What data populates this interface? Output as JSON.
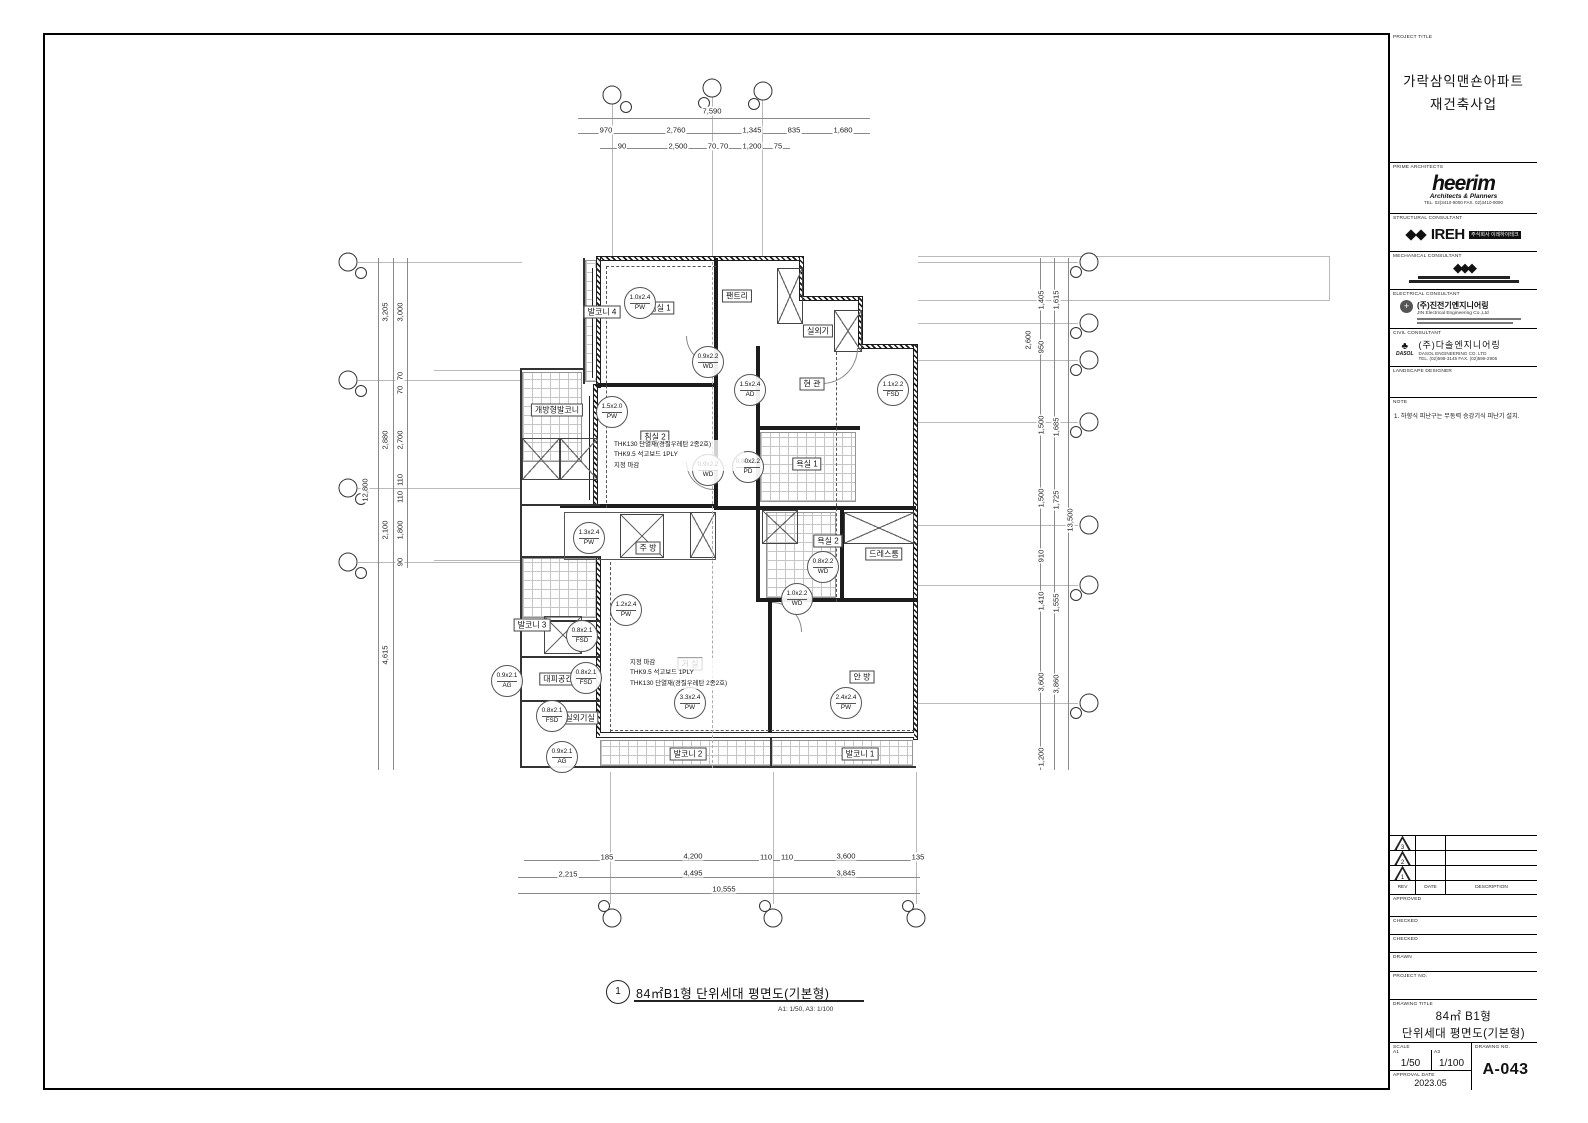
{
  "plan": {
    "rooms": [
      "침실 1",
      "침실 2",
      "팬트리",
      "실외기",
      "현 관",
      "욕실 1",
      "욕실 2",
      "드레스룸",
      "주 방",
      "거 실",
      "안 방",
      "발코니 1",
      "발코니 2",
      "발코니 3",
      "발코니 4",
      "개방형발코니",
      "대피공간",
      "실외기실"
    ],
    "tags": [
      {
        "s": "1.0x2.4",
        "c": "PW"
      },
      {
        "s": "0.9x2.2",
        "c": "WD"
      },
      {
        "s": "1.5x2.4",
        "c": "AD"
      },
      {
        "s": "1.1x2.2",
        "c": "FSD"
      },
      {
        "s": "1.5x2.0",
        "c": "PW"
      },
      {
        "s": "0.9x2.2",
        "c": "WD"
      },
      {
        "s": "0.80x2.2",
        "c": "PD"
      },
      {
        "s": "1.3x2.4",
        "c": "PW"
      },
      {
        "s": "1.2x2.4",
        "c": "PW"
      },
      {
        "s": "0.8x2.1",
        "c": "FSD"
      },
      {
        "s": "0.8x2.1",
        "c": "FSD"
      },
      {
        "s": "0.9x2.1",
        "c": "AG"
      },
      {
        "s": "0.8x2.1",
        "c": "FSD"
      },
      {
        "s": "0.9x2.1",
        "c": "AG"
      },
      {
        "s": "1.0x2.2",
        "c": "WD"
      },
      {
        "s": "0.8x2.2",
        "c": "WD"
      },
      {
        "s": "3.3x2.4",
        "c": "PW"
      },
      {
        "s": "2.4x2.4",
        "c": "PW"
      }
    ],
    "ins1": [
      "THK130 단열재(경질우레탄 2종2호)",
      "THK9.5 석고보드 1PLY",
      "지정 마감"
    ],
    "ins2": [
      "지정 마감",
      "THK9.5 석고보드 1PLY",
      "THK130 단열재(경질우레탄 2종2호)"
    ],
    "dims_top": [
      "7,590",
      "970",
      "2,760",
      "1,345",
      "835",
      "1,680",
      "90",
      "2,500",
      "70",
      "70",
      "1,200",
      "75"
    ],
    "dims_bottom": [
      "185",
      "4,200",
      "110",
      "110",
      "3,600",
      "135",
      "2,215",
      "4,495",
      "3,845",
      "10,555"
    ],
    "dims_left": [
      "3,205",
      "3,000",
      "70",
      "70",
      "2,880",
      "2,700",
      "110",
      "110",
      "2,100",
      "1,800",
      "90",
      "4,615",
      "12,800"
    ],
    "dims_right": [
      "1,405",
      "1,615",
      "950",
      "1,500",
      "1,685",
      "1,500",
      "1,725",
      "910",
      "1,410",
      "1,555",
      "3,600",
      "3,860",
      "1,200",
      "13,500",
      "2,600"
    ],
    "caption": {
      "no": "1",
      "title": "84㎡B1형 단위세대 평면도(기본형)",
      "scale": "A1: 1/50,  A3: 1/100"
    }
  },
  "title_block": {
    "labels": {
      "project_title": "PROJECT TITLE",
      "prime_architects": "PRIME ARCHITECTS",
      "structural": "STRUCTURAL CONSULTANT",
      "mechanical": "MECHANICAL CONSULTANT",
      "electrical": "ELECTRICAL CONSULTANT",
      "civil": "CIVIL CONSULTANT",
      "landscape": "LANDSCAPE DESIGNER",
      "note": "NOTE",
      "rev": "REV",
      "date": "DATE",
      "description": "DESCRIPTION",
      "approved": "APPROVED",
      "checked": "CHECKED",
      "drawn": "DRAWN",
      "project_no": "PROJECT NO.",
      "drawing_title": "DRAWING TITLE",
      "scale": "SCALE",
      "a1": "A1",
      "a3": "A3",
      "drawing_no": "DRAWING NO.",
      "approval_date": "APPROVAL DATE"
    },
    "project_title_line1": "가락삼익맨숀아파트",
    "project_title_line2": "재건축사업",
    "heerim": {
      "name": "heerim",
      "sub": "Architects & Planners",
      "tel": "TEL. 02)3410-9000  FAX. 02)3410-9090"
    },
    "structural_name": "IREH",
    "structural_chip": "주식회사 이레하이테크",
    "electrical": {
      "name": "(주)진전기엔지니어링",
      "sub": "JIN Electrical Engineering Co.,Ltd"
    },
    "civil": {
      "logo": "DASOL",
      "name": "(주)다솔엔지니어링",
      "sub": "DASOL ENGINEERING CO. LTD",
      "tel": "TEL. (02)598-3145  FAX. (02)598-2905"
    },
    "note_text": "1. 하향식 피난구는 무동력 승강기식 피난기 설치.",
    "rev_nos": [
      "3",
      "2",
      "1"
    ],
    "drawing_title_line1": "84㎡ B1형",
    "drawing_title_line2": "단위세대 평면도(기본형)",
    "scale_a1": "1/50",
    "scale_a3": "1/100",
    "drawing_no": "A-043",
    "approval_date": "2023.05"
  }
}
